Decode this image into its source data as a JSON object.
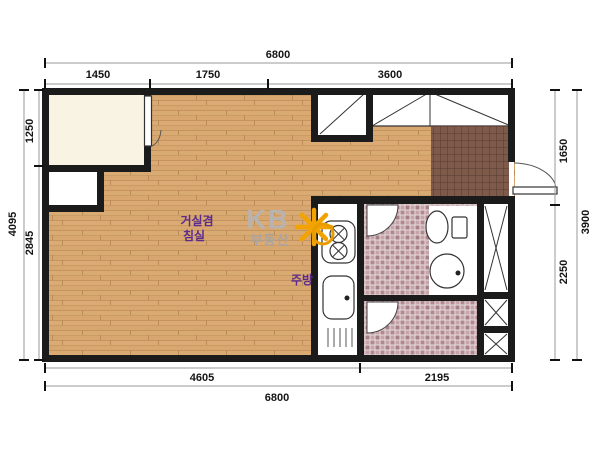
{
  "plan": {
    "labels": {
      "living_room_line1": "거실겸",
      "living_room_line2": "침실",
      "kitchen": "주방"
    },
    "watermark": {
      "brand": "KB",
      "sub": "부동산",
      "star_icon": "kb-asterisk-star"
    },
    "dimensions": {
      "top_total": "6800",
      "top_segments": [
        "1450",
        "1750",
        "3600"
      ],
      "left_total": "4095",
      "left_segments": [
        "1250",
        "2845"
      ],
      "right_segments": [
        "1650",
        "2250"
      ],
      "right_total": "3900",
      "bottom_segments": [
        "4605",
        "2195"
      ],
      "bottom_total": "6800"
    },
    "colors": {
      "wall": "#1b1b1b",
      "wood_floor": "#d7a46f",
      "balcony_cream": "#f8f3e2",
      "entrance_tile": "#7d5a4a",
      "bath_tile": "#b28990",
      "label_purple": "#5b2b8f",
      "logo_orange": "#f2a300",
      "logo_gray": "#b7b3b3",
      "dim_line_gray": "#9a9a9a"
    }
  }
}
